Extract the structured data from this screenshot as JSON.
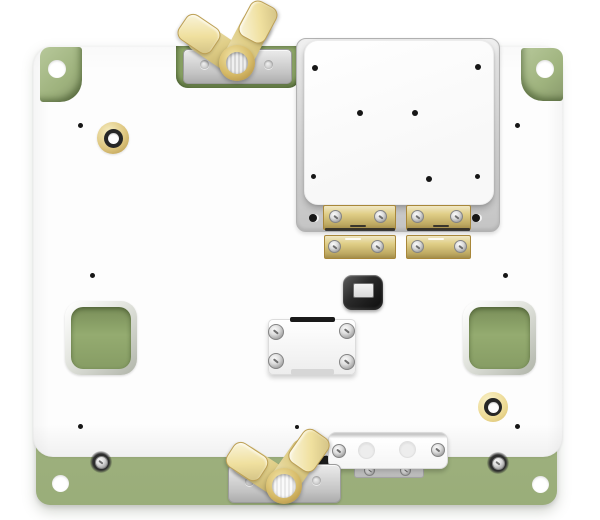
{
  "canvas": {
    "width": 600,
    "height": 520,
    "background": "#ffffff"
  },
  "palette": {
    "base-green": "#a7bc84",
    "recess-green": "#90a96a",
    "cutout-green": "#97ae72",
    "plate-white": "#fdfdfd",
    "brass": "#decb7f",
    "brass-pale": "#f3e8af",
    "metal-gray": "#c2c2c2",
    "socket-black": "#1c1c1c",
    "ink": "#161616"
  },
  "scene": {
    "description": "3D render of a test fixture: a sage-green base plate under a white top plate, with two brass wing-nut thumb screws on silver brackets, a raised white mounting plate on a gray tray held by two brass hinge clamps, a black center socket with light window, a four-screw white block, two square cutout windows showing the green base, two brass bushings, a white connector bar, corner tabs with holes and base mounting screws.",
    "parts": [
      {
        "name": "green base plate",
        "color": "sage green",
        "count": 1
      },
      {
        "name": "white top plate",
        "color": "white",
        "count": 1
      },
      {
        "name": "green corner tabs with through-holes",
        "count": 2
      },
      {
        "name": "brass wing-nut thumb screws",
        "count": 2
      },
      {
        "name": "silver mounting brackets",
        "count": 2
      },
      {
        "name": "brass hinge clamps",
        "count": 2,
        "leaves": 4,
        "screws": 8
      },
      {
        "name": "raised mounting plate",
        "count": 1,
        "screw_holes": 7
      },
      {
        "name": "gray tray under raised plate",
        "count": 1,
        "holes": 2
      },
      {
        "name": "black center socket with light window",
        "count": 1
      },
      {
        "name": "white screw-down block",
        "count": 1,
        "screws": 4
      },
      {
        "name": "square cutout windows",
        "count": 2
      },
      {
        "name": "brass bushings with white cores",
        "count": 2
      },
      {
        "name": "white connector bar",
        "count": 1,
        "screws": 2,
        "standoffs": 2
      },
      {
        "name": "base strip screws",
        "count": 2
      },
      {
        "name": "base strip through-holes",
        "count": 2
      },
      {
        "name": "small black plate holes",
        "count": 6
      }
    ]
  }
}
